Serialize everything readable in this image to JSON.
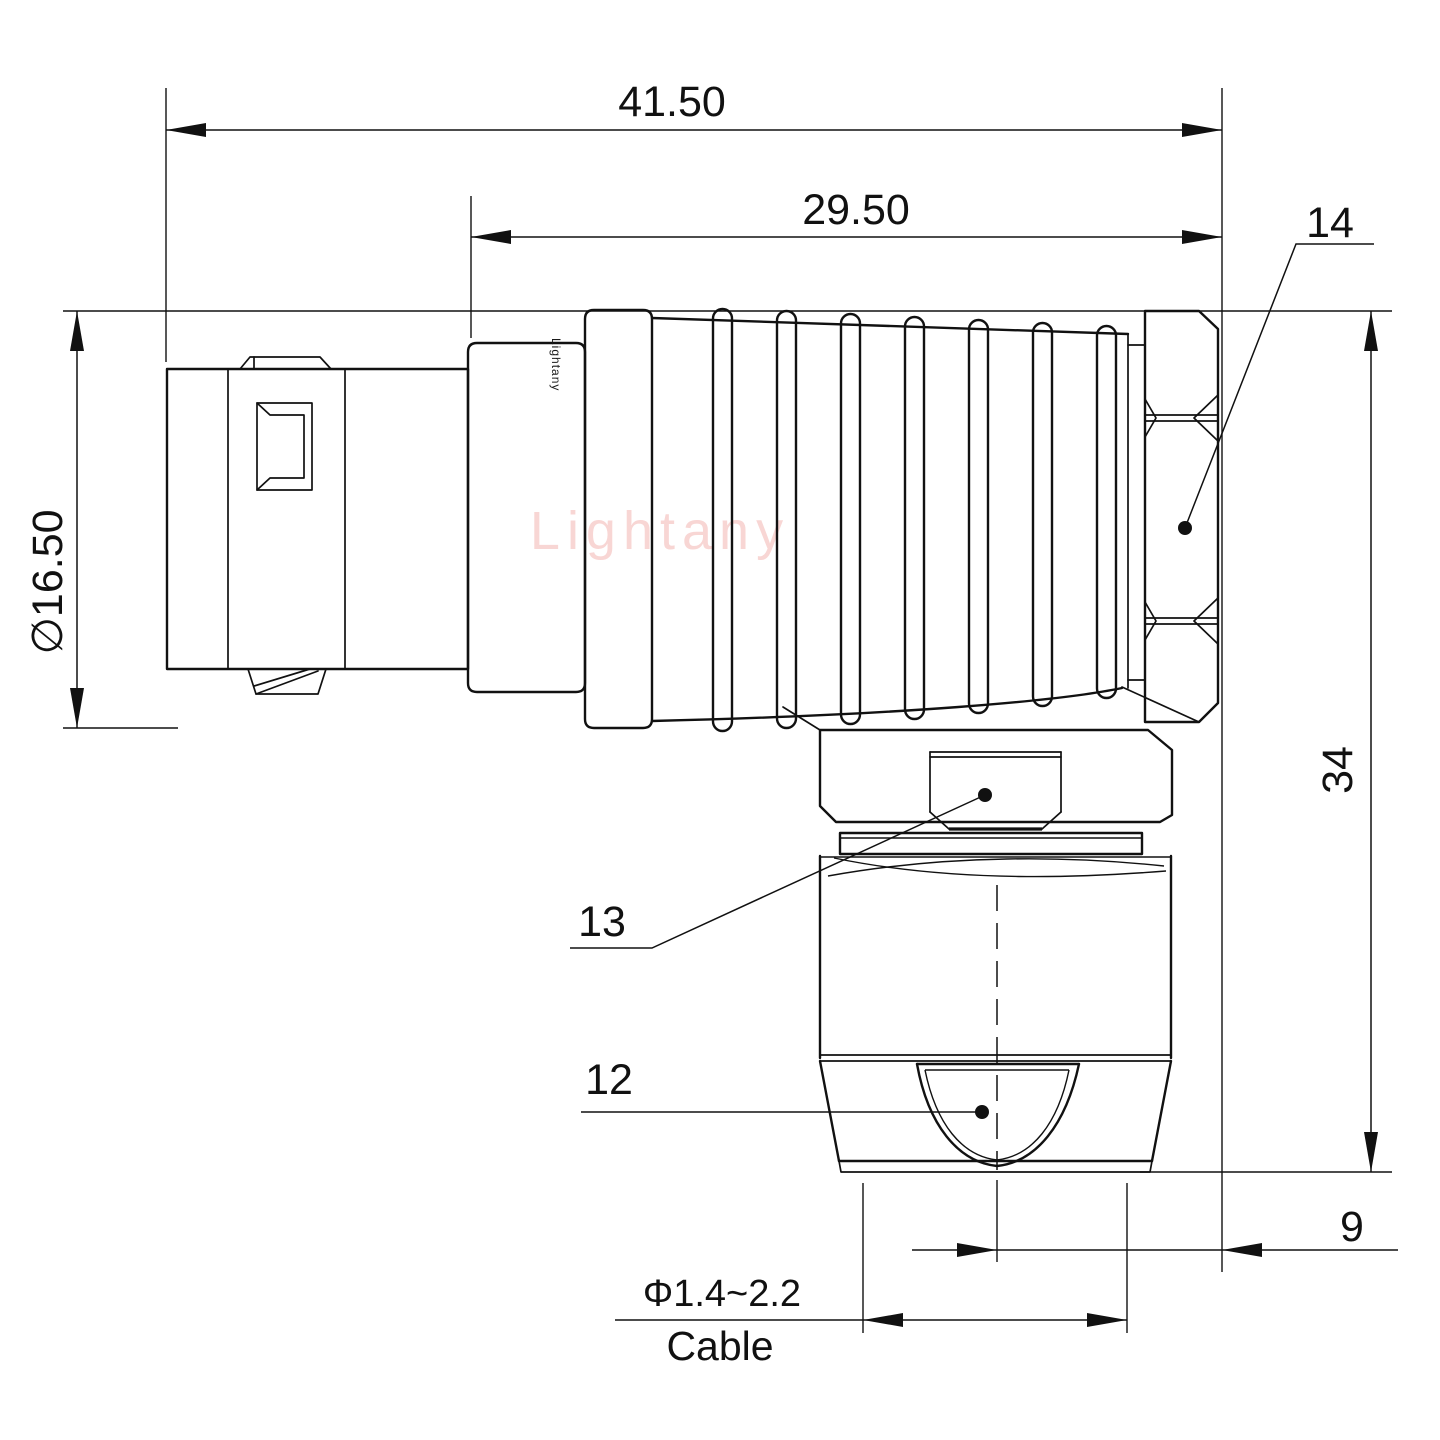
{
  "drawing": {
    "watermark": "Lightany",
    "body_engraving": "Lightany",
    "dimensions": {
      "overall_length": "41.50",
      "rear_section_length": "29.50",
      "front_diameter": "∅16.50",
      "overall_height": "34",
      "rear_offset": "9",
      "cable_diameter_range": "Φ1.4~2.2",
      "cable_word": "Cable"
    },
    "part_labels": {
      "back_nut": "14",
      "hex_body": "13",
      "cable_clamp": "12"
    },
    "colors": {
      "line": "#111111",
      "watermark_pink": "#ef9e9a",
      "background": "#ffffff"
    }
  }
}
